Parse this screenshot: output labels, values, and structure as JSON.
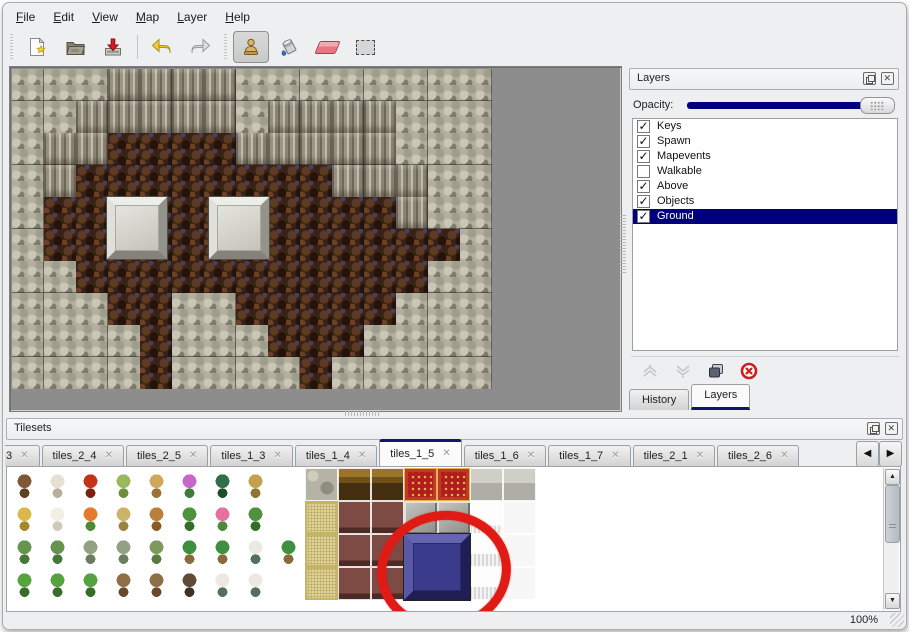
{
  "window": {
    "background": "#edeff1",
    "selection_color": "#00007e",
    "annotation_color": "#e01a14"
  },
  "menu_bar": {
    "items": [
      {
        "label": "File"
      },
      {
        "label": "Edit"
      },
      {
        "label": "View"
      },
      {
        "label": "Map"
      },
      {
        "label": "Layer"
      },
      {
        "label": "Help"
      }
    ]
  },
  "toolbar": {
    "buttons": [
      {
        "name": "new-file-button"
      },
      {
        "name": "open-file-button"
      },
      {
        "name": "save-file-button"
      },
      {
        "name": "undo-button"
      },
      {
        "name": "redo-button"
      },
      {
        "name": "stamp-tool-button",
        "active": true
      },
      {
        "name": "fill-tool-button"
      },
      {
        "name": "eraser-tool-button"
      },
      {
        "name": "select-tool-button"
      }
    ]
  },
  "map_view": {
    "tile_size": 32,
    "legend": {
      "S": "stone-wall",
      "C": "cliff-face",
      "F": "dirt-floor"
    },
    "tiles": [
      "SSSCCCCSSSSSSSS",
      "SSCCCCCSCCCCSSS",
      "SCCFFFFCCCCCSSS",
      "SCFFFFFFFFCCCSS",
      "SFFFFFFFFFFFCSS",
      "SFFFFFFFFFFFFFS",
      "SSFFFFFFFFFFFSS",
      "SSSFFSSFFFFFSSS",
      "SSSSFSSSFFFSSSS",
      "SSSSFSSSSFSSSSS"
    ],
    "pedestals": [
      {
        "x": 95,
        "y": 128,
        "w": 60,
        "h": 62
      },
      {
        "x": 197,
        "y": 128,
        "w": 60,
        "h": 62
      }
    ]
  },
  "layers_panel": {
    "title": "Layers",
    "opacity_label": "Opacity:",
    "opacity_percent": 100,
    "layers": [
      {
        "name": "Keys",
        "checked": true,
        "selected": false
      },
      {
        "name": "Spawn",
        "checked": true,
        "selected": false
      },
      {
        "name": "Mapevents",
        "checked": true,
        "selected": false
      },
      {
        "name": "Walkable",
        "checked": false,
        "selected": false
      },
      {
        "name": "Above",
        "checked": true,
        "selected": false
      },
      {
        "name": "Objects",
        "checked": true,
        "selected": false
      },
      {
        "name": "Ground",
        "checked": true,
        "selected": true
      }
    ],
    "buttons": [
      {
        "name": "move-layer-up-button",
        "enabled": false
      },
      {
        "name": "move-layer-down-button",
        "enabled": false
      },
      {
        "name": "duplicate-layer-button",
        "enabled": true
      },
      {
        "name": "delete-layer-button",
        "enabled": true
      }
    ],
    "tabs": [
      {
        "label": "History",
        "active": false
      },
      {
        "label": "Layers",
        "active": true
      }
    ]
  },
  "tilesets_panel": {
    "title": "Tilesets",
    "tabs": [
      {
        "label": "3",
        "active": false,
        "partial": true
      },
      {
        "label": "tiles_2_4",
        "active": false
      },
      {
        "label": "tiles_2_5",
        "active": false
      },
      {
        "label": "tiles_1_3",
        "active": false
      },
      {
        "label": "tiles_1_4",
        "active": false
      },
      {
        "label": "tiles_1_5",
        "active": true
      },
      {
        "label": "tiles_1_6",
        "active": false
      },
      {
        "label": "tiles_1_7",
        "active": false
      },
      {
        "label": "tiles_2_1",
        "active": false
      },
      {
        "label": "tiles_2_6",
        "active": false
      }
    ],
    "tile_size": 33,
    "grid": [
      [
        "tree",
        "snowtree",
        "bigflower",
        "stump",
        "trunk",
        "purpleflower",
        "fern",
        "drygrass",
        "blank",
        "stonetile",
        "woodtile",
        "woodtile",
        "redcarpet",
        "redcarpet",
        "silvertile",
        "silvertile"
      ],
      [
        "hay",
        "snowmound",
        "orangeflowers",
        "grasstuft",
        "leaves",
        "lilypad",
        "pinkflower",
        "lilypad",
        "blank",
        "tanwoven",
        "maroontile",
        "maroontile",
        "gray3d",
        "gray3d",
        "whitepuffy",
        "whitetile"
      ],
      [
        "sprouts",
        "sprouts",
        "bush",
        "bush",
        "sprig",
        "palm",
        "palm",
        "snowpine",
        "palm",
        "tanwoven",
        "maroontile",
        "maroontile",
        "bluetile",
        "bluetile",
        "curtain",
        "whitetile"
      ],
      [
        "conifer",
        "conifer",
        "conifer",
        "deadtree",
        "deadtree",
        "darktree",
        "snowpine",
        "snowpine",
        "blank",
        "tanwoven",
        "maroontile",
        "maroontile",
        "bluetile",
        "bluetile",
        "curtain",
        "whitetile"
      ]
    ],
    "sprite_palette": {
      "tree": [
        "#7d5a34",
        "#5d4222"
      ],
      "snowtree": [
        "#e4e0d2",
        "#b8b09c"
      ],
      "bigflower": [
        "#c23418",
        "#7e1e0c"
      ],
      "stump": [
        "#9cb85c",
        "#6f8f3a"
      ],
      "trunk": [
        "#cfa85e",
        "#9a7434"
      ],
      "purpleflower": [
        "#c964c9",
        "#3f7a3a"
      ],
      "fern": [
        "#2f7046",
        "#1d4f2e"
      ],
      "drygrass": [
        "#c2a24e",
        "#8f7432"
      ],
      "hay": [
        "#d9b94c",
        "#a8862e"
      ],
      "snowmound": [
        "#f2efe6",
        "#cfc9b8"
      ],
      "orangeflowers": [
        "#e27b2c",
        "#4e8a38"
      ],
      "grasstuft": [
        "#cdb369",
        "#9a8444"
      ],
      "leaves": [
        "#b8803a",
        "#8a5a22"
      ],
      "lilypad": [
        "#4f913d",
        "#356e28"
      ],
      "pinkflower": [
        "#e4719f",
        "#4e8a38"
      ],
      "sprouts": [
        "#64944e",
        "#47773a"
      ],
      "bush": [
        "#93a183",
        "#6d7c60"
      ],
      "sprig": [
        "#7d9a5e",
        "#597a40"
      ],
      "palm": [
        "#3e8f3e",
        "#8a6a3a"
      ],
      "snowpine": [
        "#eceae0",
        "#53705a"
      ],
      "conifer": [
        "#55a23e",
        "#356e28"
      ],
      "deadtree": [
        "#8f6f46",
        "#66492a"
      ],
      "darktree": [
        "#5e4c38",
        "#3e3223"
      ]
    },
    "selected_tile": {
      "kind": "bluetile",
      "row": 2,
      "col": 12,
      "span": 2
    }
  },
  "status_bar": {
    "zoom_level": "100%"
  }
}
